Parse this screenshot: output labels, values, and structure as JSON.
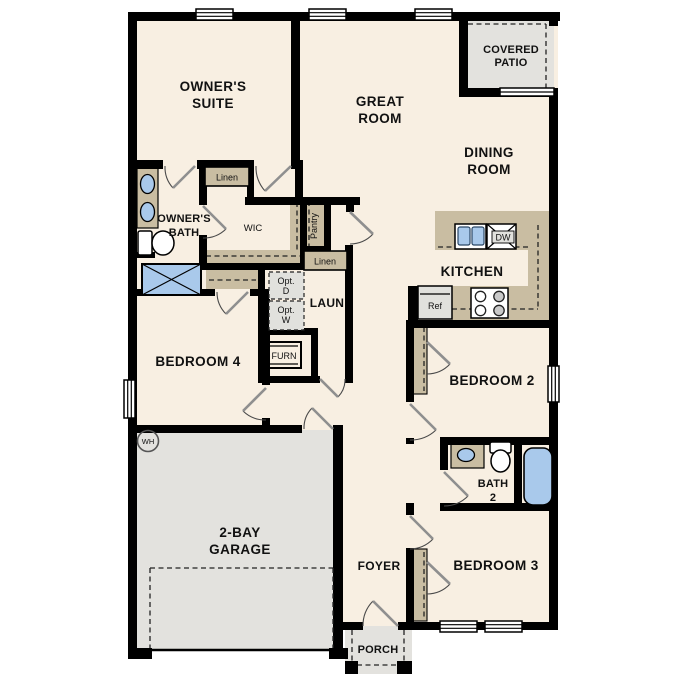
{
  "colors": {
    "wall": "#000000",
    "floor": "#f8efe2",
    "tan": "#c9bda2",
    "gray": "#e3e2de",
    "gray_box": "#e1e1dd",
    "blue": "#a9c9eb",
    "door": "#8f8f8f",
    "text": "#111111"
  },
  "labels": {
    "owners_suite": [
      "OWNER'S",
      "SUITE"
    ],
    "great_room": [
      "GREAT",
      "ROOM"
    ],
    "covered_patio": [
      "COVERED",
      "PATIO"
    ],
    "dining_room": [
      "DINING",
      "ROOM"
    ],
    "kitchen": "KITCHEN",
    "owners_bath": [
      "OWNER'S",
      "BATH"
    ],
    "wic": "WIC",
    "pantry": "Pantry",
    "linen1": "Linen",
    "linen2": "Linen",
    "laundry": "LAUN",
    "opt_d": [
      "Opt.",
      "D"
    ],
    "opt_w": [
      "Opt.",
      "W"
    ],
    "furnace": "FURN",
    "bedroom4": "BEDROOM 4",
    "bedroom2": "BEDROOM 2",
    "bath2": [
      "BATH",
      "2"
    ],
    "bedroom3": "BEDROOM 3",
    "garage": [
      "2-BAY",
      "GARAGE"
    ],
    "foyer": "FOYER",
    "porch": "PORCH",
    "water_heater": "WH",
    "refrigerator": "Ref",
    "dishwasher": "DW"
  }
}
